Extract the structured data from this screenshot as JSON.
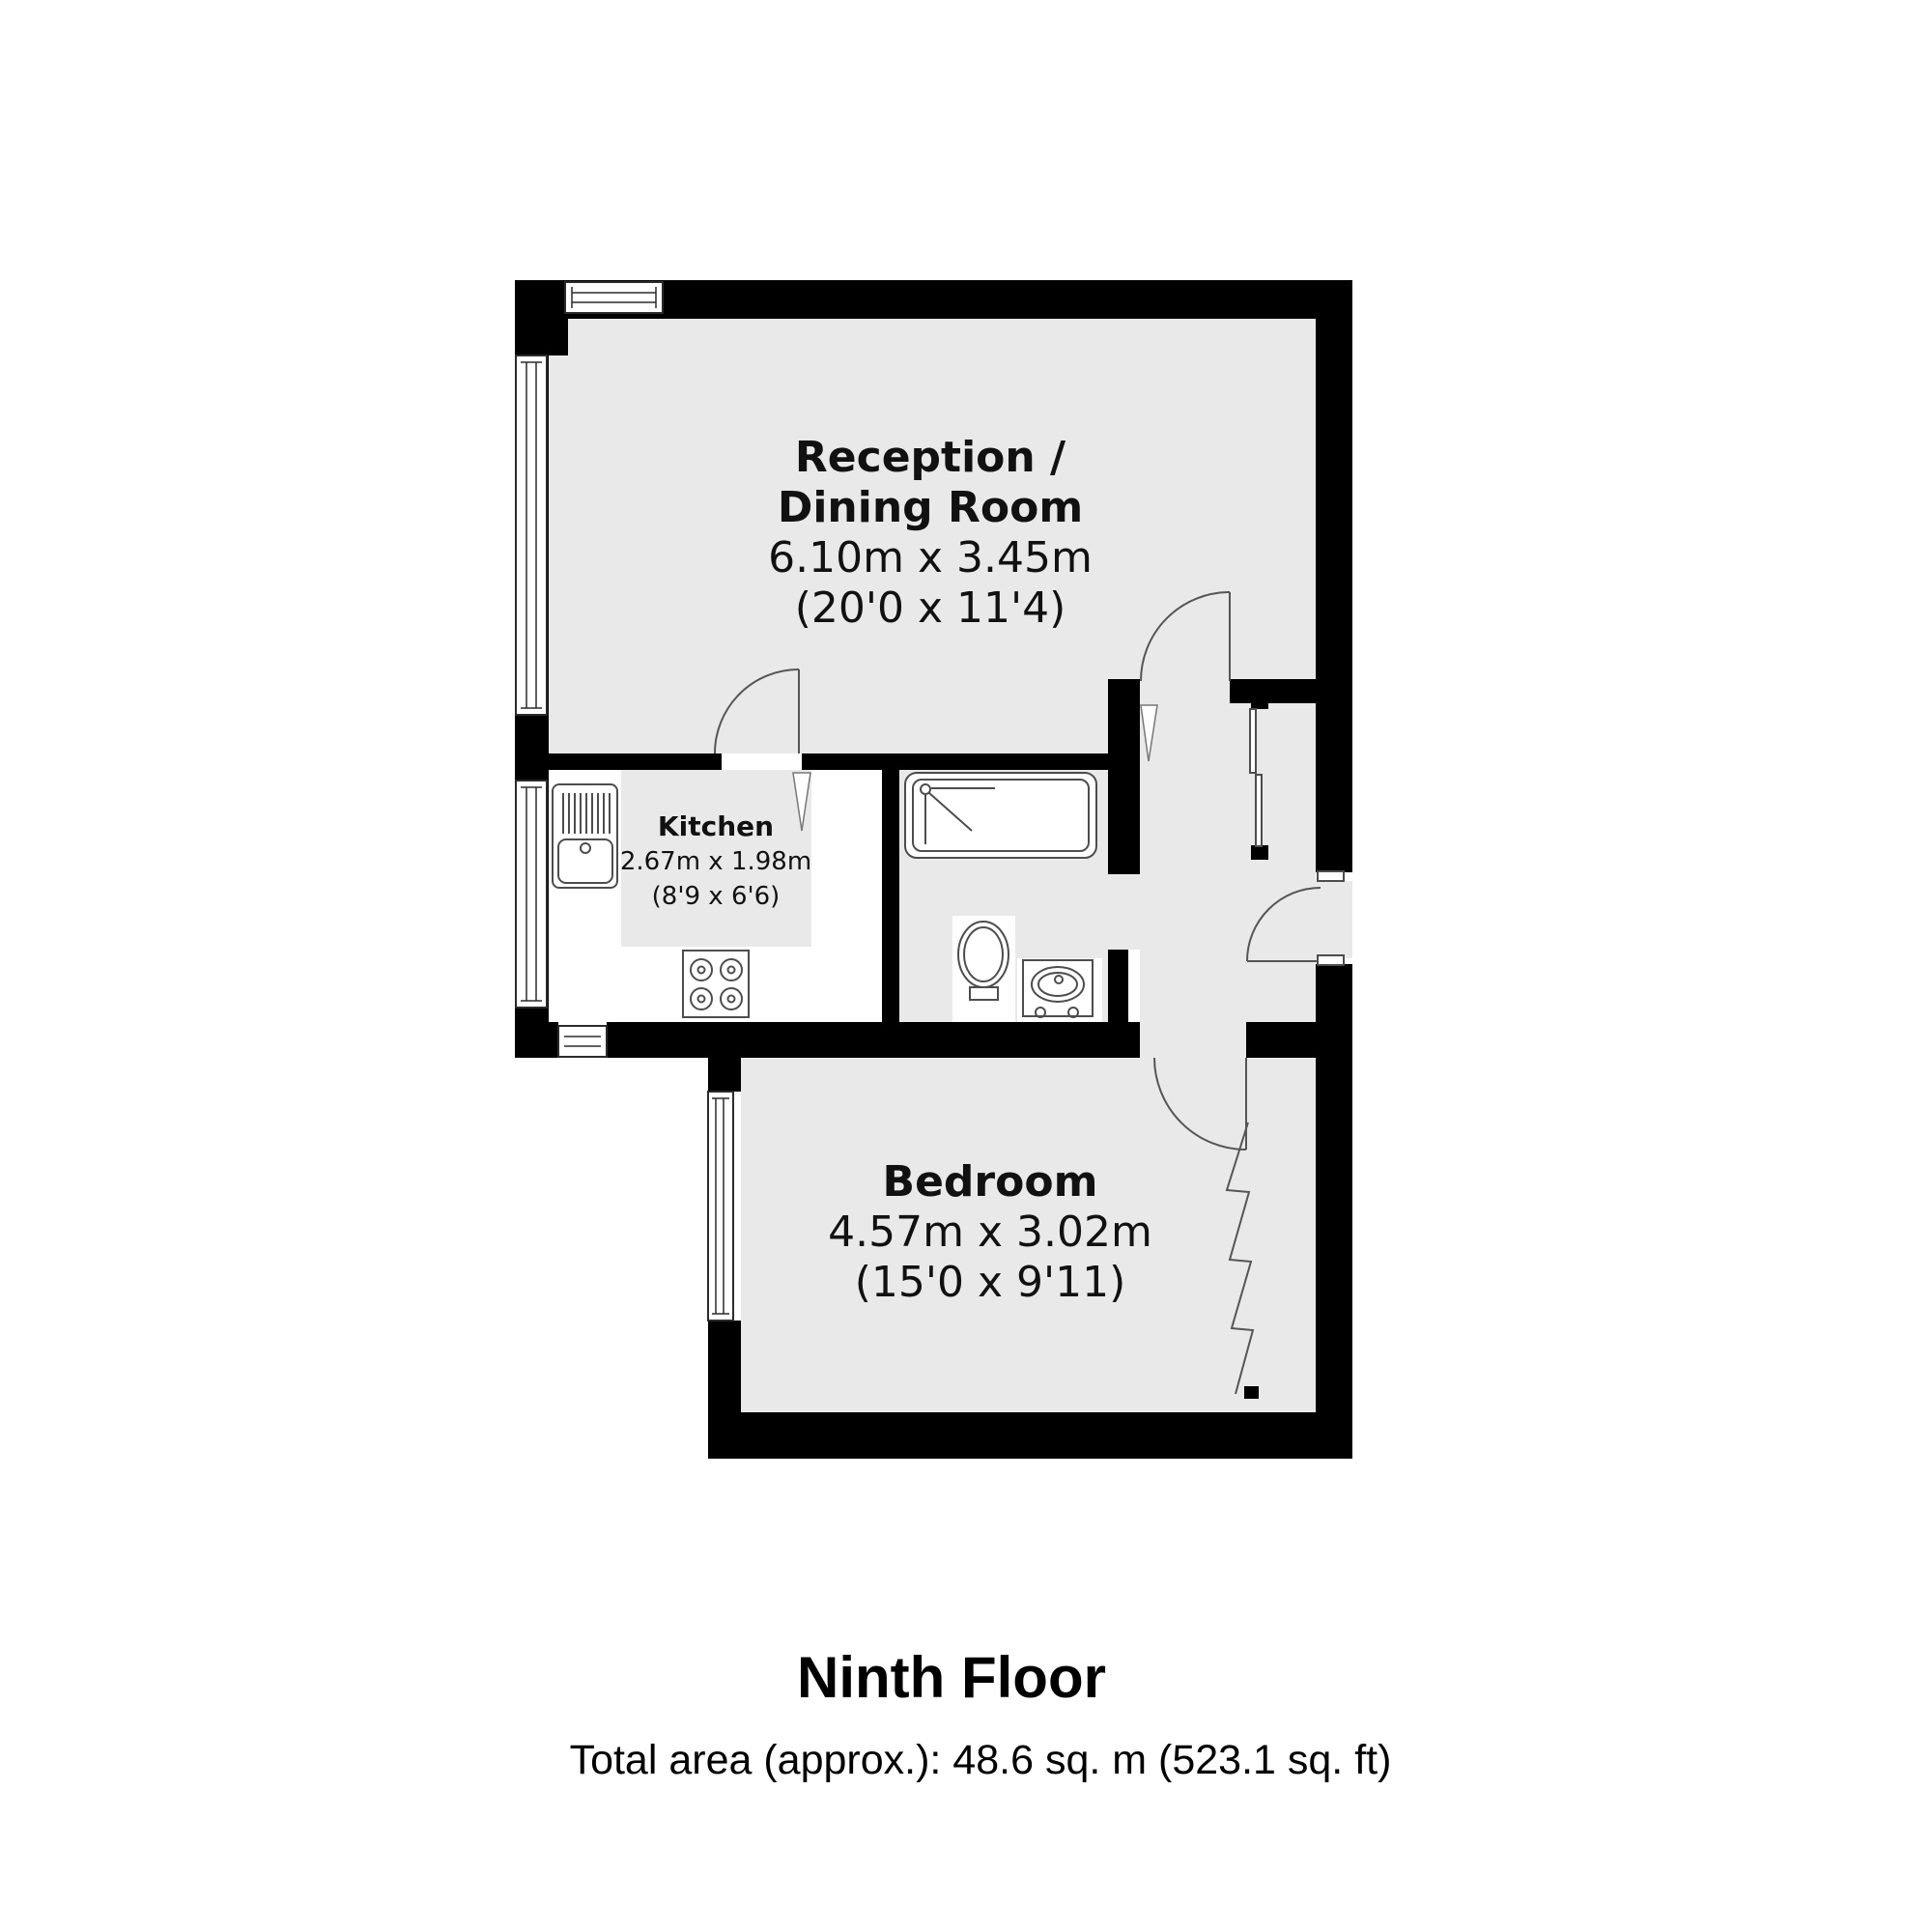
{
  "colors": {
    "wall": "#000000",
    "floor": "#e9e9e9",
    "fixture_line": "#4d4d4d"
  },
  "rooms": {
    "reception": {
      "name_line1": "Reception /",
      "name_line2": "Dining Room",
      "dimensions_metric": "6.10m x 3.45m",
      "dimensions_imperial": "(20'0 x 11'4)"
    },
    "kitchen": {
      "name": "Kitchen",
      "dimensions_metric": "2.67m x 1.98m",
      "dimensions_imperial": "(8'9 x 6'6)"
    },
    "bedroom": {
      "name": "Bedroom",
      "dimensions_metric": "4.57m x 3.02m",
      "dimensions_imperial": "(15'0 x 9'11)"
    }
  },
  "fixtures": {
    "bathtub": "bathtub-with-shower",
    "toilet": "toilet",
    "basin": "wash-basin",
    "kitchen_sink": "sink-and-drainer",
    "hob": "four-ring-hob",
    "wardrobe_door": "bifold-wardrobe-door",
    "cupboard": "hall-cupboard"
  },
  "footer": {
    "floor_label": "Ninth Floor",
    "total_area": "Total area (approx.): 48.6 sq. m (523.1 sq. ft)"
  }
}
